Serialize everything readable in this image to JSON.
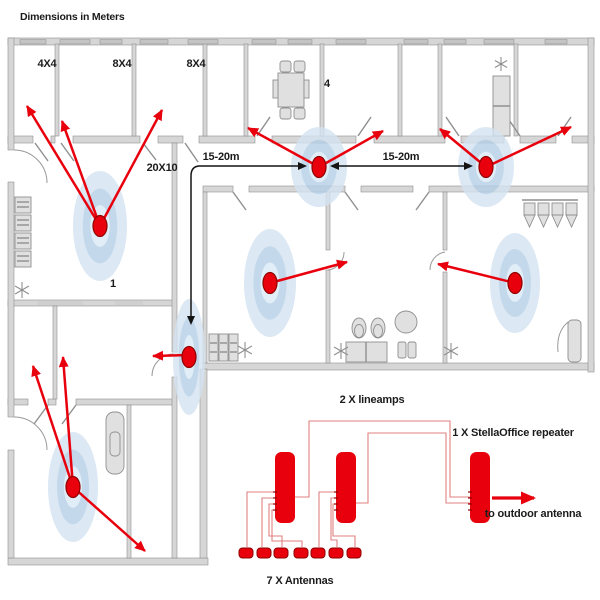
{
  "title": "Dimensions in Meters",
  "colors": {
    "accent_red": "#e8000d",
    "dot_stroke": "#8f0000",
    "wire_red": "#e08080",
    "halo_outer": "#d4e3f1",
    "halo_mid": "#b5d0e7",
    "halo_inner": "#dcebf6",
    "wall_gray": "#d6d6d6",
    "text": "#1b1b1b"
  },
  "floorplan": {
    "room_labels": [
      {
        "id": "room-4x4",
        "text": "4X4"
      },
      {
        "id": "room-8x4-a",
        "text": "8X4"
      },
      {
        "id": "room-8x4-b",
        "text": "8X4"
      },
      {
        "id": "room-4",
        "text": "4"
      },
      {
        "id": "room-20x10",
        "text": "20X10"
      },
      {
        "id": "room-1",
        "text": "1"
      }
    ],
    "antennas": [
      {
        "x": 100,
        "y": 226,
        "halo_rx": 27,
        "halo_ry": 55
      },
      {
        "x": 319,
        "y": 167,
        "halo_rx": 28,
        "halo_ry": 40
      },
      {
        "x": 486,
        "y": 167,
        "halo_rx": 28,
        "halo_ry": 40
      },
      {
        "x": 189,
        "y": 357,
        "halo_rx": 16,
        "halo_ry": 58
      },
      {
        "x": 515,
        "y": 283,
        "halo_rx": 25,
        "halo_ry": 50
      },
      {
        "x": 270,
        "y": 283,
        "halo_rx": 26,
        "halo_ry": 54
      },
      {
        "x": 73,
        "y": 487,
        "halo_rx": 25,
        "halo_ry": 55
      }
    ],
    "signal_arrows": [
      [
        100,
        226,
        27,
        106
      ],
      [
        100,
        226,
        62,
        121
      ],
      [
        100,
        226,
        162,
        110
      ],
      [
        319,
        167,
        248,
        128
      ],
      [
        319,
        167,
        383,
        131
      ],
      [
        486,
        167,
        440,
        129
      ],
      [
        486,
        167,
        571,
        127
      ],
      [
        189,
        355,
        153,
        356
      ],
      [
        515,
        283,
        438,
        264
      ],
      [
        270,
        283,
        347,
        262
      ],
      [
        73,
        487,
        33,
        366
      ],
      [
        73,
        487,
        63,
        357
      ],
      [
        73,
        487,
        145,
        551
      ]
    ],
    "measures": [
      {
        "label": "15-20m",
        "line": "M303,166 H200 Q191,166 191,176 V320",
        "heads": [
          [
            306,
            166,
            "r"
          ],
          [
            191,
            324,
            "d"
          ]
        ]
      },
      {
        "label": "15-20m",
        "line": "M333,166 H470",
        "heads": [
          [
            331,
            166,
            "l"
          ],
          [
            472,
            166,
            "r"
          ]
        ]
      }
    ]
  },
  "schematic": {
    "lineamps_label": "2 X lineamps",
    "repeater_label": "1 X StellaOffice repeater",
    "antennas_label": "7 X Antennas",
    "outdoor_label": "to outdoor antenna",
    "devices": [
      {
        "name": "lineamp-1",
        "x": 275,
        "y": 452,
        "w": 20,
        "h": 71
      },
      {
        "name": "lineamp-2",
        "x": 336,
        "y": 452,
        "w": 20,
        "h": 71
      },
      {
        "name": "stellaoffice-repeater",
        "x": 470,
        "y": 452,
        "w": 20,
        "h": 71
      }
    ],
    "wires": [
      "M295,497 H309 V421 H450 V497 H470",
      "M356,503 H368 V433 H446 V503 H470",
      "M276,492 H247 V547",
      "M276,498 H262 V547",
      "M276,504 H269 V536 H282 V547",
      "M276,510 H272 V541 H302 V547",
      "M337,492 H319 V547",
      "M337,498 H331 V540 H337 V547",
      "M337,504 H333 V536 H355 V547"
    ],
    "antenna_row": {
      "xs": [
        246,
        264,
        281,
        301,
        318,
        336,
        354
      ],
      "y": 548,
      "w": 14,
      "h": 10
    },
    "outdoor_arrow": [
      492,
      498,
      534,
      498
    ]
  }
}
